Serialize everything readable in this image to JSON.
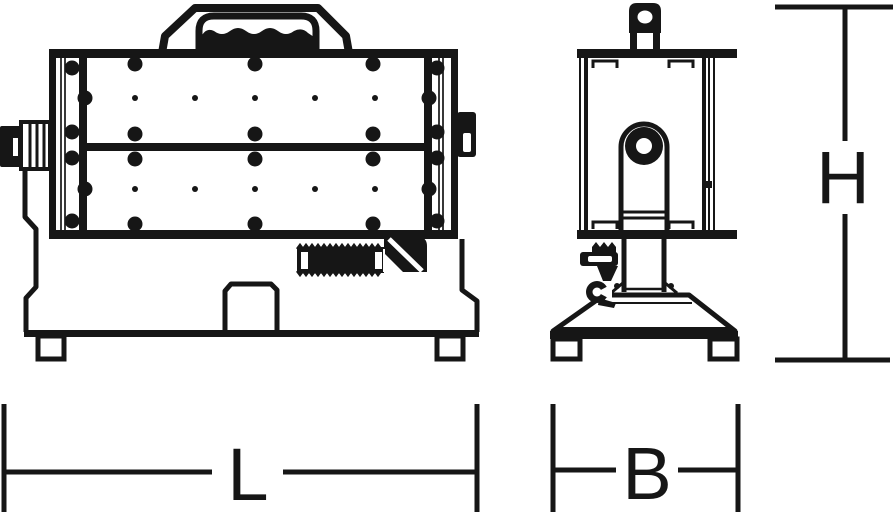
{
  "drawing": {
    "kind": "technical-dimension-drawing",
    "views": [
      {
        "id": "front-view"
      },
      {
        "id": "side-view"
      }
    ]
  },
  "dimensions": {
    "length": {
      "label": "L",
      "orientation": "horizontal",
      "view": "front-view"
    },
    "width": {
      "label": "B",
      "orientation": "horizontal",
      "view": "side-view"
    },
    "height": {
      "label": "H",
      "orientation": "vertical",
      "view": "side-view"
    }
  },
  "colors": {
    "line": "#161616",
    "background": "#ffffff"
  }
}
